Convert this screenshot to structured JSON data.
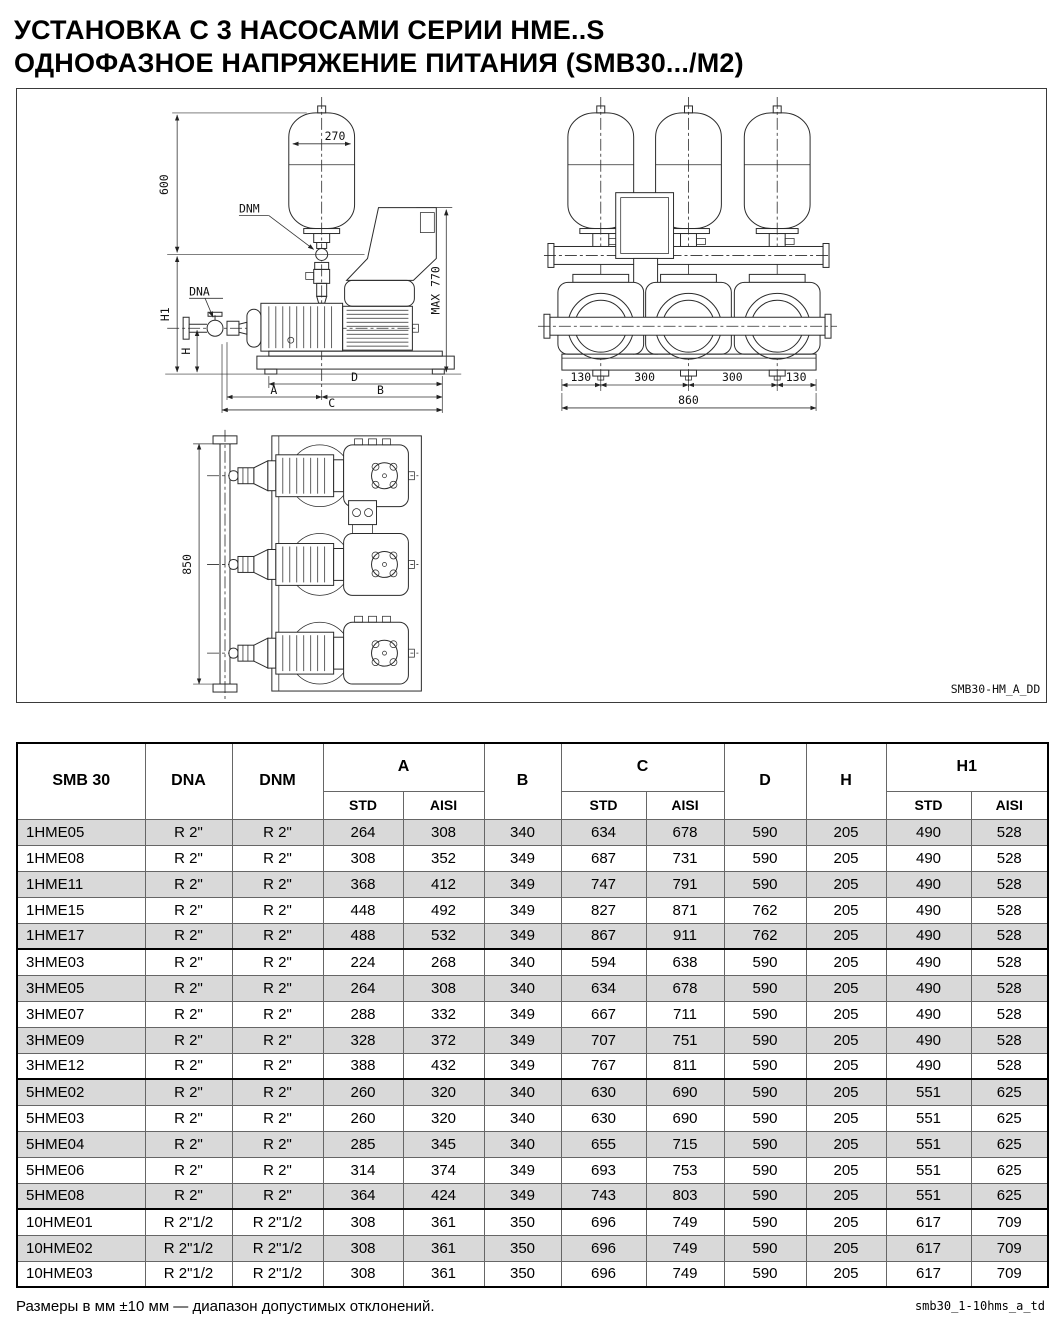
{
  "title": {
    "line1": "УСТАНОВКА С 3 НАСОСАМИ СЕРИИ HME..S",
    "line2": "ОДНОФАЗНОЕ НАПРЯЖЕНИЕ ПИТАНИЯ (SMB30.../M2)"
  },
  "colors": {
    "row_shade": "#d9d9d9"
  },
  "diagram": {
    "code": "SMB30-HM_A_DD",
    "side": {
      "tank_dia": "270",
      "height": "600",
      "h1": "H1",
      "h": "H",
      "max": "MAX 770",
      "dnm": "DNM",
      "dna": "DNA",
      "a": "A",
      "b": "B",
      "c": "C",
      "d": "D"
    },
    "front": {
      "s1": "130",
      "s2": "300",
      "s3": "300",
      "s4": "130",
      "total": "860"
    },
    "top": {
      "depth": "850"
    }
  },
  "table": {
    "header": {
      "model": "SMB 30",
      "dna": "DNA",
      "dnm": "DNM",
      "a": "A",
      "b": "B",
      "c": "C",
      "d": "D",
      "h": "H",
      "h1": "H1",
      "std": "STD",
      "aisi": "AISI"
    },
    "rows": [
      {
        "model": "1HME05",
        "dna": "R 2\"",
        "dnm": "R 2\"",
        "a_std": "264",
        "a_aisi": "308",
        "b": "340",
        "c_std": "634",
        "c_aisi": "678",
        "d": "590",
        "h": "205",
        "h1_std": "490",
        "h1_aisi": "528"
      },
      {
        "model": "1HME08",
        "dna": "R 2\"",
        "dnm": "R 2\"",
        "a_std": "308",
        "a_aisi": "352",
        "b": "349",
        "c_std": "687",
        "c_aisi": "731",
        "d": "590",
        "h": "205",
        "h1_std": "490",
        "h1_aisi": "528"
      },
      {
        "model": "1HME11",
        "dna": "R 2\"",
        "dnm": "R 2\"",
        "a_std": "368",
        "a_aisi": "412",
        "b": "349",
        "c_std": "747",
        "c_aisi": "791",
        "d": "590",
        "h": "205",
        "h1_std": "490",
        "h1_aisi": "528"
      },
      {
        "model": "1HME15",
        "dna": "R 2\"",
        "dnm": "R 2\"",
        "a_std": "448",
        "a_aisi": "492",
        "b": "349",
        "c_std": "827",
        "c_aisi": "871",
        "d": "762",
        "h": "205",
        "h1_std": "490",
        "h1_aisi": "528"
      },
      {
        "model": "1HME17",
        "dna": "R 2\"",
        "dnm": "R 2\"",
        "a_std": "488",
        "a_aisi": "532",
        "b": "349",
        "c_std": "867",
        "c_aisi": "911",
        "d": "762",
        "h": "205",
        "h1_std": "490",
        "h1_aisi": "528"
      },
      {
        "model": "3HME03",
        "dna": "R 2\"",
        "dnm": "R 2\"",
        "a_std": "224",
        "a_aisi": "268",
        "b": "340",
        "c_std": "594",
        "c_aisi": "638",
        "d": "590",
        "h": "205",
        "h1_std": "490",
        "h1_aisi": "528"
      },
      {
        "model": "3HME05",
        "dna": "R 2\"",
        "dnm": "R 2\"",
        "a_std": "264",
        "a_aisi": "308",
        "b": "340",
        "c_std": "634",
        "c_aisi": "678",
        "d": "590",
        "h": "205",
        "h1_std": "490",
        "h1_aisi": "528"
      },
      {
        "model": "3HME07",
        "dna": "R 2\"",
        "dnm": "R 2\"",
        "a_std": "288",
        "a_aisi": "332",
        "b": "349",
        "c_std": "667",
        "c_aisi": "711",
        "d": "590",
        "h": "205",
        "h1_std": "490",
        "h1_aisi": "528"
      },
      {
        "model": "3HME09",
        "dna": "R 2\"",
        "dnm": "R 2\"",
        "a_std": "328",
        "a_aisi": "372",
        "b": "349",
        "c_std": "707",
        "c_aisi": "751",
        "d": "590",
        "h": "205",
        "h1_std": "490",
        "h1_aisi": "528"
      },
      {
        "model": "3HME12",
        "dna": "R 2\"",
        "dnm": "R 2\"",
        "a_std": "388",
        "a_aisi": "432",
        "b": "349",
        "c_std": "767",
        "c_aisi": "811",
        "d": "590",
        "h": "205",
        "h1_std": "490",
        "h1_aisi": "528"
      },
      {
        "model": "5HME02",
        "dna": "R 2\"",
        "dnm": "R 2\"",
        "a_std": "260",
        "a_aisi": "320",
        "b": "340",
        "c_std": "630",
        "c_aisi": "690",
        "d": "590",
        "h": "205",
        "h1_std": "551",
        "h1_aisi": "625"
      },
      {
        "model": "5HME03",
        "dna": "R 2\"",
        "dnm": "R 2\"",
        "a_std": "260",
        "a_aisi": "320",
        "b": "340",
        "c_std": "630",
        "c_aisi": "690",
        "d": "590",
        "h": "205",
        "h1_std": "551",
        "h1_aisi": "625"
      },
      {
        "model": "5HME04",
        "dna": "R 2\"",
        "dnm": "R 2\"",
        "a_std": "285",
        "a_aisi": "345",
        "b": "340",
        "c_std": "655",
        "c_aisi": "715",
        "d": "590",
        "h": "205",
        "h1_std": "551",
        "h1_aisi": "625"
      },
      {
        "model": "5HME06",
        "dna": "R 2\"",
        "dnm": "R 2\"",
        "a_std": "314",
        "a_aisi": "374",
        "b": "349",
        "c_std": "693",
        "c_aisi": "753",
        "d": "590",
        "h": "205",
        "h1_std": "551",
        "h1_aisi": "625"
      },
      {
        "model": "5HME08",
        "dna": "R 2\"",
        "dnm": "R 2\"",
        "a_std": "364",
        "a_aisi": "424",
        "b": "349",
        "c_std": "743",
        "c_aisi": "803",
        "d": "590",
        "h": "205",
        "h1_std": "551",
        "h1_aisi": "625"
      },
      {
        "model": "10HME01",
        "dna": "R 2\"1/2",
        "dnm": "R 2\"1/2",
        "a_std": "308",
        "a_aisi": "361",
        "b": "350",
        "c_std": "696",
        "c_aisi": "749",
        "d": "590",
        "h": "205",
        "h1_std": "617",
        "h1_aisi": "709"
      },
      {
        "model": "10HME02",
        "dna": "R 2\"1/2",
        "dnm": "R 2\"1/2",
        "a_std": "308",
        "a_aisi": "361",
        "b": "350",
        "c_std": "696",
        "c_aisi": "749",
        "d": "590",
        "h": "205",
        "h1_std": "617",
        "h1_aisi": "709"
      },
      {
        "model": "10HME03",
        "dna": "R 2\"1/2",
        "dnm": "R 2\"1/2",
        "a_std": "308",
        "a_aisi": "361",
        "b": "350",
        "c_std": "696",
        "c_aisi": "749",
        "d": "590",
        "h": "205",
        "h1_std": "617",
        "h1_aisi": "709"
      }
    ]
  },
  "footer": {
    "note": "Размеры в мм ±10 мм — диапазон допустимых отклонений.",
    "doc_code": "smb30_1-10hms_a_td"
  }
}
